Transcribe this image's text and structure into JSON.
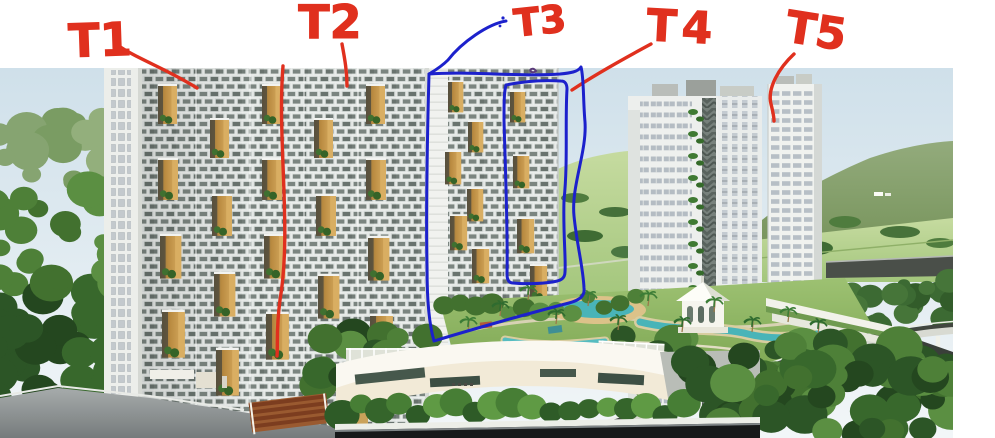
{
  "annotations": {
    "colors": {
      "red": "#e0301e",
      "blue": "#1c21cc"
    },
    "labels": [
      {
        "id": "t1",
        "text": "T1",
        "ink": "red",
        "leader": "red"
      },
      {
        "id": "t2",
        "text": "T2",
        "ink": "red",
        "leader": "red"
      },
      {
        "id": "t3",
        "text": "T3",
        "ink": "red",
        "leader": "blue"
      },
      {
        "id": "t4",
        "text": "T4",
        "ink": "red",
        "leader": "red"
      },
      {
        "id": "t5",
        "text": "T5",
        "ink": "red",
        "leader": "red"
      }
    ]
  },
  "palette": {
    "anno_red": "#e0301e",
    "anno_blue": "#1c21cc",
    "sky_top": "#cfe0ea",
    "sky_low": "#f2f6f8",
    "hill": "#7e9a60",
    "field": "#b4d28c",
    "forest_dark": "#2c5526",
    "forest_mid": "#4e8038",
    "forest_light": "#86a471",
    "facade_frame": "#dfe4e2",
    "facade_glass": "#7b8580",
    "niche_tan": "#c59045",
    "tower_wall": "#edefed",
    "tower_glass": "#b6bec5",
    "pool": "#49b4b8",
    "sand": "#dcc289",
    "lawn": "#8db763",
    "clubhouse": "#f2ead7",
    "road_dark": "#4a4f49",
    "wall_dark": "#17191a",
    "pergola": "#7c3d1f",
    "path_gray": "#9aa0a2"
  }
}
